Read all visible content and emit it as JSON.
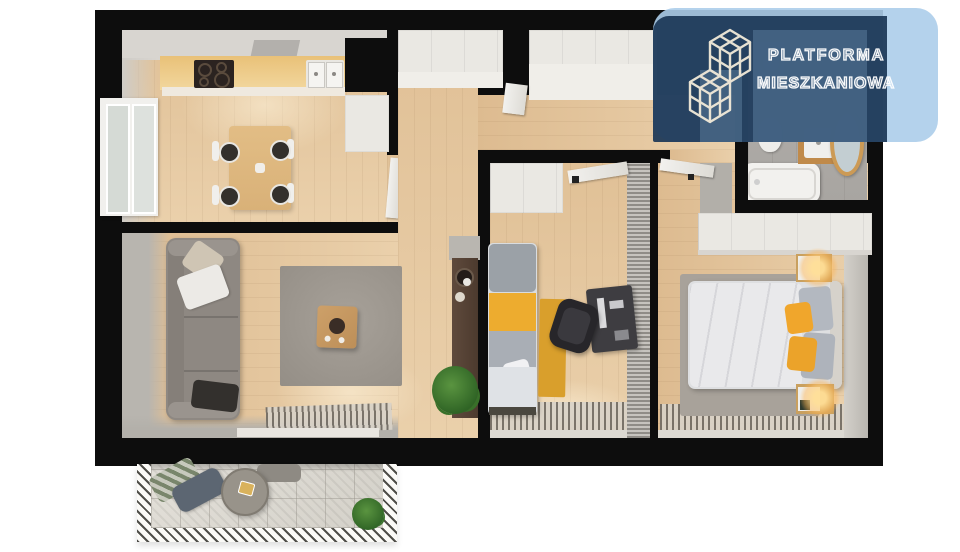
{
  "logo": {
    "brand_line1": "PLATFORMA",
    "brand_line2": "MIESZKANIOWA",
    "icon": "isometric-cubes-logo-icon",
    "colors": {
      "card": "#a9cdec",
      "panel": "#1d3a5c",
      "text": "#ffffff"
    }
  },
  "palette": {
    "wall": "#0d0d0d",
    "wood_floor": "#e2c39b",
    "white_furniture": "#eae8e3",
    "accent_yellow": "#edac2f",
    "sofa_gray": "#8e8882",
    "rug_gray": "#9e978f",
    "lamp_glow": "#ffc970",
    "balcony_tile": "#dcd9d2",
    "plant_green": "#3f7a33",
    "bathroom_wood": "#c08a4a"
  },
  "scene": {
    "type": "apartment-3d-floorplan-top-view",
    "rooms": [
      {
        "name": "kitchen-dining",
        "furniture": [
          "cooktop",
          "double-sink",
          "kitchen-counter",
          "range-hood",
          "window",
          "dining-table",
          "four-chairs",
          "tall-cabinet"
        ]
      },
      {
        "name": "hallway",
        "furniture": [
          "entrance-door",
          "built-in-wardrobes",
          "console-table",
          "potted-plant",
          "interior-doors"
        ]
      },
      {
        "name": "living-room",
        "furniture": [
          "sofa",
          "pillows",
          "area-rug",
          "coffee-table",
          "striped-runner",
          "balcony-door"
        ]
      },
      {
        "name": "small-bedroom",
        "furniture": [
          "wardrobe",
          "single-bed",
          "yellow-runner",
          "desk",
          "office-chair",
          "striped-runner",
          "ribbed-panel"
        ]
      },
      {
        "name": "master-bedroom",
        "furniture": [
          "double-bed",
          "two-nightstands-with-lamps",
          "long-wardrobe",
          "area-rug",
          "striped-runner"
        ]
      },
      {
        "name": "bathroom",
        "furniture": [
          "bathtub",
          "vanity-sink",
          "round-mirror",
          "toilet",
          "washer"
        ]
      },
      {
        "name": "balcony",
        "furniture": [
          "lounge-cushions",
          "round-table",
          "potted-plant"
        ]
      }
    ]
  }
}
